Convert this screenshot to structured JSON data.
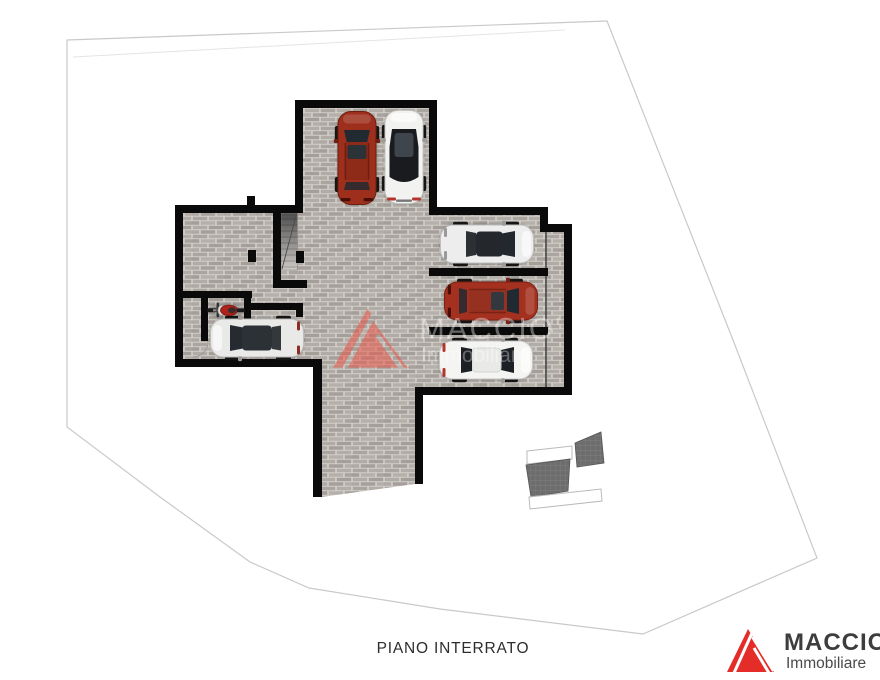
{
  "floor_plan": {
    "label": "PIANO INTERRATO",
    "type": "basement-garage-plan"
  },
  "agency": {
    "name": "MACCIO'",
    "subtitle": "Immobiliare"
  },
  "watermark": {
    "name": "MACCIO'",
    "subtitle": "Immobiliare"
  },
  "colors": {
    "logo_red": "#e42d28",
    "watermark_red": "#ee4f41",
    "wall_black": "#0a0a0a",
    "boundary_gray": "#c9c9c9",
    "label_gray": "#2d2d2d",
    "floor_base": "#aeA9a3"
  },
  "vehicles": {
    "cars": [
      {
        "id": "red-suv",
        "area": "north-garage",
        "facing": "up",
        "color": "#9e2f1d"
      },
      {
        "id": "white-car-black-roof",
        "area": "north-garage",
        "facing": "up",
        "color": "#f2f2f1"
      },
      {
        "id": "silver-car",
        "area": "east-bay-1",
        "facing": "right",
        "color": "#ededed"
      },
      {
        "id": "red-car",
        "area": "east-bay-2",
        "facing": "right",
        "color": "#a43120"
      },
      {
        "id": "white-car",
        "area": "east-bay-3",
        "facing": "right",
        "color": "#f4f4f3"
      },
      {
        "id": "silver-city-car",
        "area": "west-room",
        "facing": "left",
        "color": "#e9e9e8"
      }
    ],
    "motorcycle": {
      "id": "red-motorcycle",
      "area": "west-room",
      "facing": "left",
      "color": "#b0231a"
    }
  }
}
